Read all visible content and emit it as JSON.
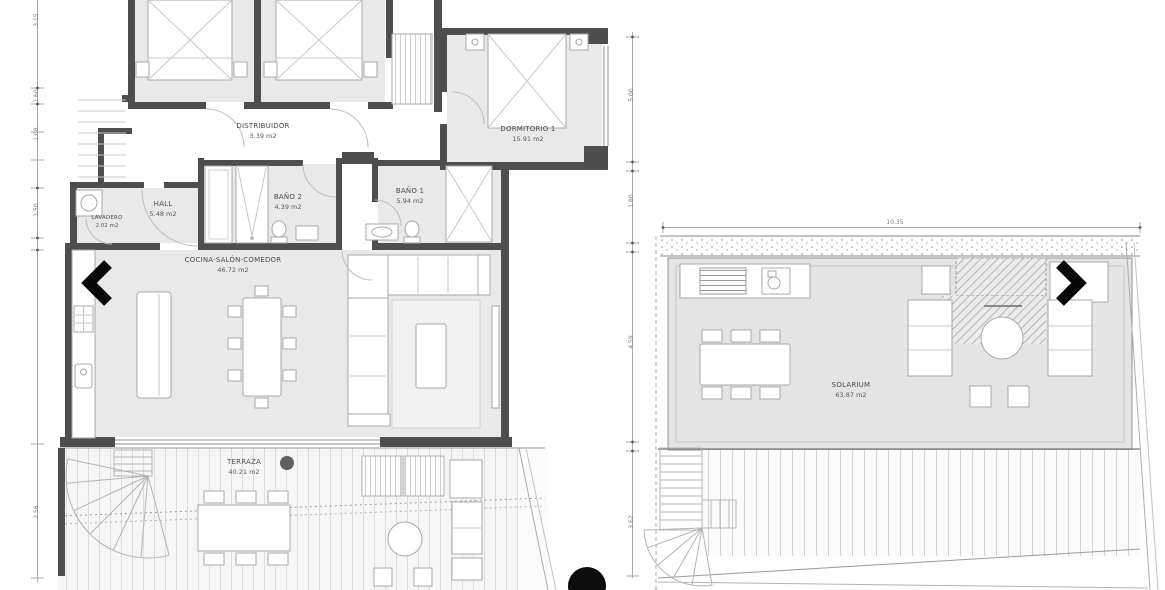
{
  "palette": {
    "wall": "#4e4e4e",
    "room_fill": "#e9e9e9",
    "line": "#a8a8a8",
    "label": "#4a4a4a",
    "accent_black": "#0c0c0c"
  },
  "carousel": {
    "prev_icon": "left-chevron",
    "next_icon": "right-chevron",
    "indicator_icon": "black-dot"
  },
  "apartment_plan": {
    "rooms": [
      {
        "id": "distribuidor",
        "label": "DISTRIBUIDOR",
        "area": "3.39 m2"
      },
      {
        "id": "dormitorio-1",
        "label": "DORMITORIO 1",
        "area": "15.91 m2"
      },
      {
        "id": "hall",
        "label": "HALL",
        "area": "5.48 m2"
      },
      {
        "id": "lavadero",
        "label": "LAVADERO",
        "area": "2.02 m2"
      },
      {
        "id": "bano-2",
        "label": "BAÑO 2",
        "area": "4.39 m2"
      },
      {
        "id": "bano-1",
        "label": "BAÑO 1",
        "area": "5.94 m2"
      },
      {
        "id": "cocina-salon-comedor",
        "label": "COCINA-SALÓN-COMEDOR",
        "area": "46.72 m2"
      },
      {
        "id": "terraza",
        "label": "TERRAZA",
        "area": "40.21 m2"
      }
    ],
    "side_dimensions": [
      "3.15",
      "1.60",
      "1.08",
      "1.50",
      "2.56"
    ],
    "mid_dimensions": [
      "5.00",
      "1.80",
      "4.59",
      "3.62"
    ]
  },
  "solarium_plan": {
    "rooms": [
      {
        "id": "solarium",
        "label": "SOLARIUM",
        "area": "63.87 m2"
      }
    ],
    "top_dimension": "10.35"
  }
}
